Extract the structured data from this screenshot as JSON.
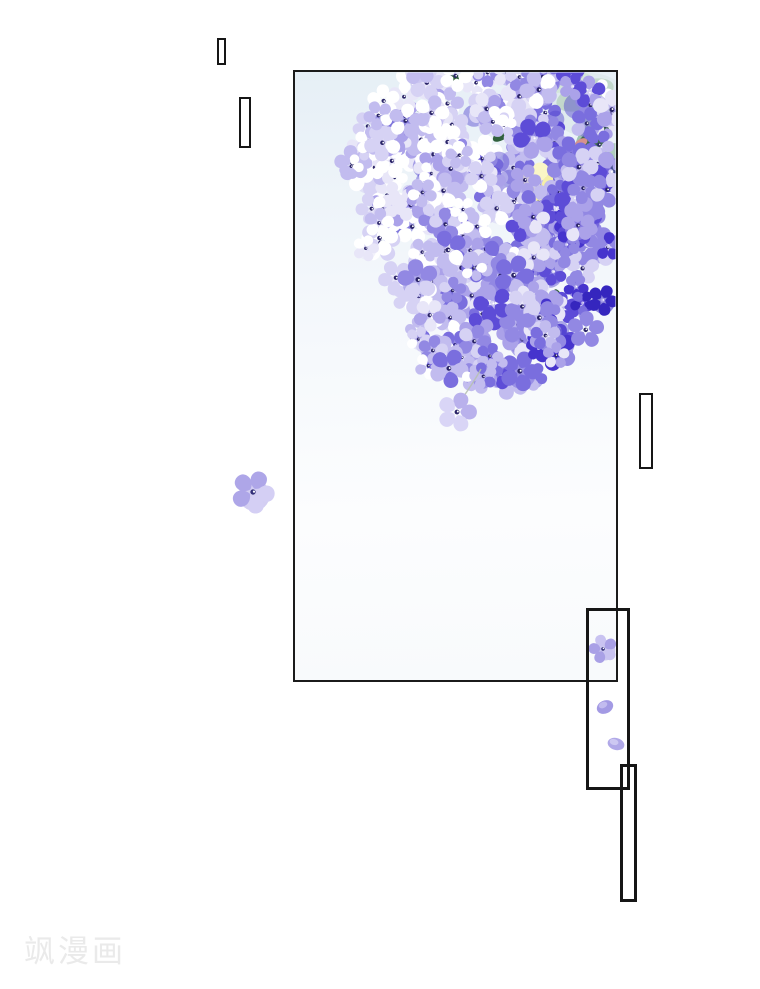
{
  "page": {
    "background_color": "#ffffff"
  },
  "watermark": {
    "text": "飒漫画",
    "color": "#eaeaea"
  },
  "panel": {
    "border_color": "#1b1b1b",
    "background_top": "#e6eff6",
    "background_mid": "#f3f7fb",
    "background_bottom": "#fcfdfe"
  },
  "text_boxes": {
    "count": 5,
    "border_color": "#161616",
    "fill": "transparent",
    "note_visible_text": ""
  },
  "artwork": {
    "subject": "hydrangea-blossom-cluster",
    "flower_palette": [
      "#ffffff",
      "#e8e6f8",
      "#d6d2f4",
      "#c2bcef",
      "#aba2e9",
      "#9288e3",
      "#7a6ede",
      "#5d4cd7",
      "#4634cd",
      "#3526be"
    ],
    "flower_center_dark": "#2a2468",
    "flower_center_dot": "#ffffff",
    "gap_blob_color": "#5043cf",
    "leaf_colors": {
      "wash": "#dde9ec",
      "mint_light": "#d3e5d9",
      "mint": "#c2d8cb",
      "mint_mid": "#afcdbd",
      "mint_deep": "#9dc2af",
      "dark": "#3f6b50",
      "dark2": "#2f5a3c",
      "sprig": "#31613d",
      "salmon": "#d6918c"
    },
    "yellow_flower": {
      "base": "#f5efa8",
      "light": "#faf6c6",
      "center": "#b9ad66"
    },
    "stem_color": "#b7c0b4",
    "lone_flower_color": "#aea6e8",
    "falling_flower_color": "#b9b1ec",
    "box_flower_color": "#a9a0e6",
    "fallen_petal_colors": [
      "#a39ae4",
      "#b0a8e8"
    ]
  }
}
